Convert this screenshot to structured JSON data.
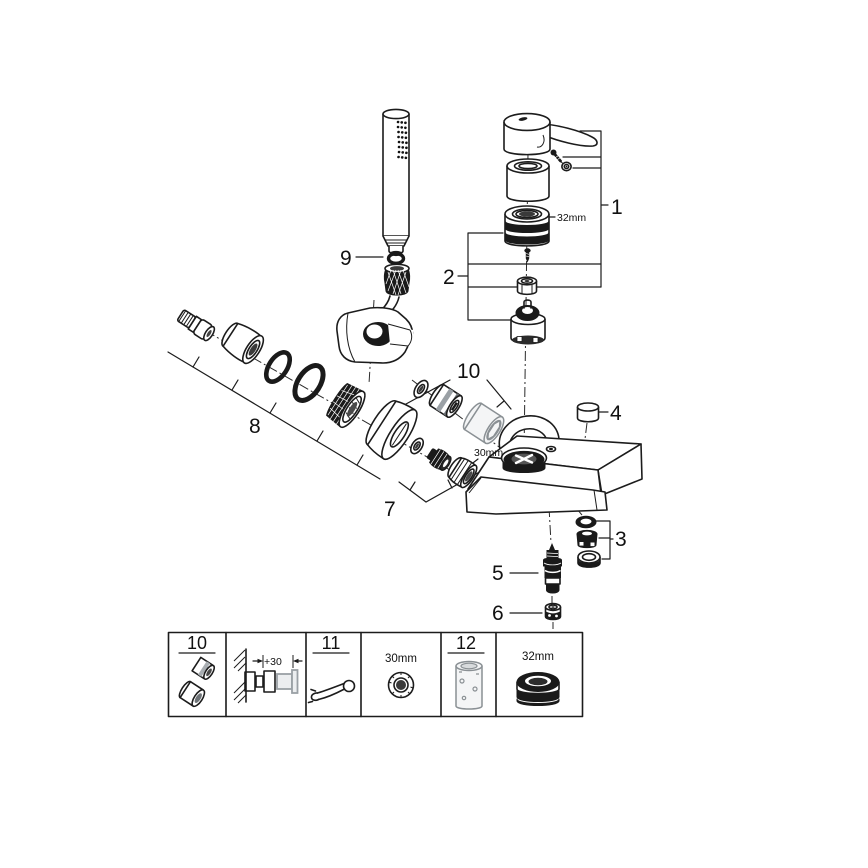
{
  "colors": {
    "line": "#1c1c1c",
    "background": "#ffffff",
    "dark_part": "#1a1a1a",
    "gray_part": "#9aa0a5"
  },
  "callouts": {
    "1": "1",
    "2": "2",
    "3": "3",
    "4": "4",
    "5": "5",
    "6": "6",
    "7": "7",
    "8": "8",
    "9": "9",
    "10": "10"
  },
  "dimensions": {
    "cartridge_ring": "32mm",
    "aerator_nut": "30mm"
  },
  "legend": {
    "cells": [
      {
        "label": "10"
      },
      {
        "dim": "+30"
      },
      {
        "label": "11"
      },
      {
        "dim": "30mm"
      },
      {
        "label": "12"
      },
      {
        "dim": "32mm"
      }
    ]
  }
}
